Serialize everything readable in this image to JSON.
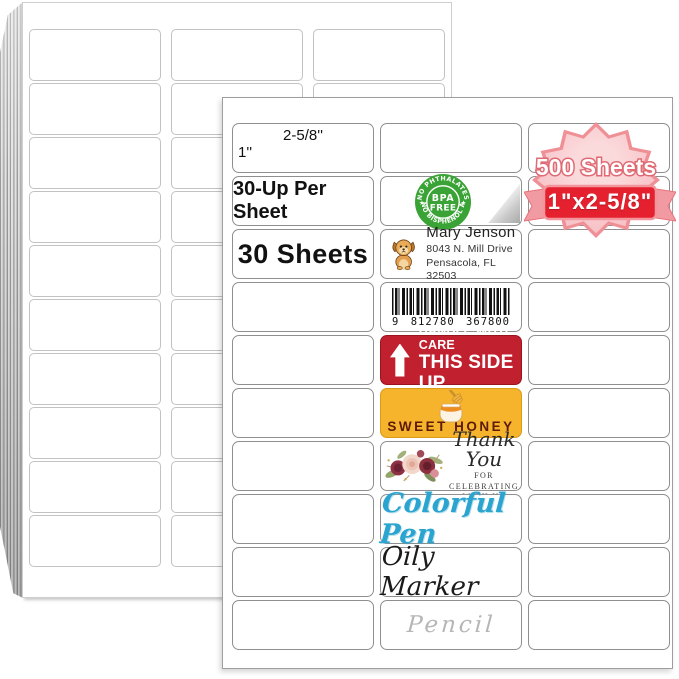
{
  "front": {
    "dim": {
      "width": "2-5/8''",
      "height": "1''"
    },
    "per_sheet": "30-Up Per Sheet",
    "sheet_count": "30 Sheets",
    "bpa": {
      "arc_top": "NO PHTHALATES",
      "arc_bottom": "NO BISPHENOL A",
      "star_left": "★",
      "star_right": "★",
      "line1": "BPA",
      "line2": "FREE"
    },
    "address": {
      "name": "Mary Jenson",
      "street": "8043 N. Mill Drive",
      "city": "Pensacola, FL 32503"
    },
    "barcode": {
      "d1": "9",
      "d2": "812780",
      "d3": "367800"
    },
    "handle": {
      "line1": "HANDLE WITH CARE",
      "line2": "THIS SIDE UP"
    },
    "honey": {
      "text": "SWEET HONEY"
    },
    "thankyou": {
      "script": "Thank You",
      "sub1": "FOR CELEBRATING",
      "sub2": "WITH US"
    },
    "pen": "Colorful Pen",
    "marker": "Oily Marker",
    "pencil": "Pencil"
  },
  "badge": {
    "sheets": "500 Sheets",
    "size": "1\"x2-5/8\""
  },
  "colors": {
    "bpa_green": "#3aa335",
    "handle_red": "#c1202f",
    "honey_yellow": "#f6b42c",
    "honey_text": "#5d1a06",
    "pen_blue": "#2ba4cf",
    "badge_pink": "#f7c3c8",
    "badge_border": "#ef8f96",
    "ribbon_red": "#e6212f"
  },
  "back_sheet": {
    "rows": 10,
    "cols": 3
  }
}
